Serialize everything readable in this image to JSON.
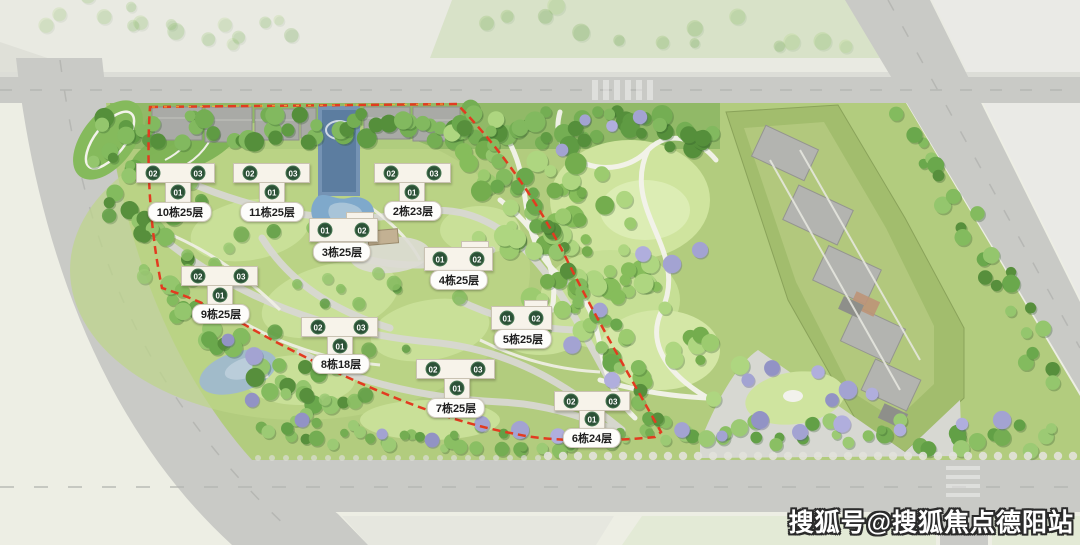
{
  "watermark": {
    "text": "搜狐号@搜狐焦点德阳站"
  },
  "site_plan": {
    "boundary_color": "#e23b20",
    "building_fill": "#f7f3ea",
    "unit_marker_color": "#2c5137",
    "buildings": [
      {
        "id": "10",
        "name": "10栋25层",
        "shape": "T",
        "units": [
          {
            "id": "02",
            "x": 153,
            "y": 173
          },
          {
            "id": "03",
            "x": 198,
            "y": 173
          },
          {
            "id": "01",
            "x": 178,
            "y": 192
          }
        ],
        "label": {
          "x": 180,
          "y": 212
        }
      },
      {
        "id": "11",
        "name": "11栋25层",
        "shape": "T",
        "units": [
          {
            "id": "02",
            "x": 250,
            "y": 173
          },
          {
            "id": "03",
            "x": 293,
            "y": 173
          },
          {
            "id": "01",
            "x": 272,
            "y": 192
          }
        ],
        "label": {
          "x": 272,
          "y": 212
        }
      },
      {
        "id": "2",
        "name": "2栋23层",
        "shape": "T",
        "units": [
          {
            "id": "02",
            "x": 391,
            "y": 173
          },
          {
            "id": "03",
            "x": 434,
            "y": 173
          },
          {
            "id": "01",
            "x": 412,
            "y": 192
          }
        ],
        "label": {
          "x": 413,
          "y": 211
        }
      },
      {
        "id": "3",
        "name": "3栋25层",
        "shape": "bar",
        "units": [
          {
            "id": "01",
            "x": 325,
            "y": 230
          },
          {
            "id": "02",
            "x": 362,
            "y": 230
          }
        ],
        "label": {
          "x": 342,
          "y": 252
        }
      },
      {
        "id": "4",
        "name": "4栋25层",
        "shape": "bar",
        "units": [
          {
            "id": "01",
            "x": 440,
            "y": 259
          },
          {
            "id": "02",
            "x": 477,
            "y": 259
          }
        ],
        "label": {
          "x": 459,
          "y": 280
        }
      },
      {
        "id": "9",
        "name": "9栋25层",
        "shape": "T",
        "units": [
          {
            "id": "02",
            "x": 198,
            "y": 276
          },
          {
            "id": "03",
            "x": 241,
            "y": 276
          },
          {
            "id": "01",
            "x": 220,
            "y": 295
          }
        ],
        "label": {
          "x": 221,
          "y": 314
        }
      },
      {
        "id": "8",
        "name": "8栋18层",
        "shape": "T",
        "units": [
          {
            "id": "02",
            "x": 318,
            "y": 327
          },
          {
            "id": "03",
            "x": 361,
            "y": 327
          },
          {
            "id": "01",
            "x": 340,
            "y": 346
          }
        ],
        "label": {
          "x": 341,
          "y": 364
        }
      },
      {
        "id": "5",
        "name": "5栋25层",
        "shape": "bar",
        "units": [
          {
            "id": "01",
            "x": 507,
            "y": 318
          },
          {
            "id": "02",
            "x": 536,
            "y": 318
          }
        ],
        "label": {
          "x": 523,
          "y": 339
        }
      },
      {
        "id": "7",
        "name": "7栋25层",
        "shape": "T",
        "units": [
          {
            "id": "02",
            "x": 433,
            "y": 369
          },
          {
            "id": "03",
            "x": 478,
            "y": 369
          },
          {
            "id": "01",
            "x": 457,
            "y": 388
          }
        ],
        "label": {
          "x": 456,
          "y": 408
        }
      },
      {
        "id": "6",
        "name": "6栋24层",
        "shape": "T",
        "units": [
          {
            "id": "02",
            "x": 571,
            "y": 401
          },
          {
            "id": "03",
            "x": 613,
            "y": 401
          },
          {
            "id": "01",
            "x": 592,
            "y": 419
          }
        ],
        "label": {
          "x": 592,
          "y": 438
        }
      }
    ]
  }
}
